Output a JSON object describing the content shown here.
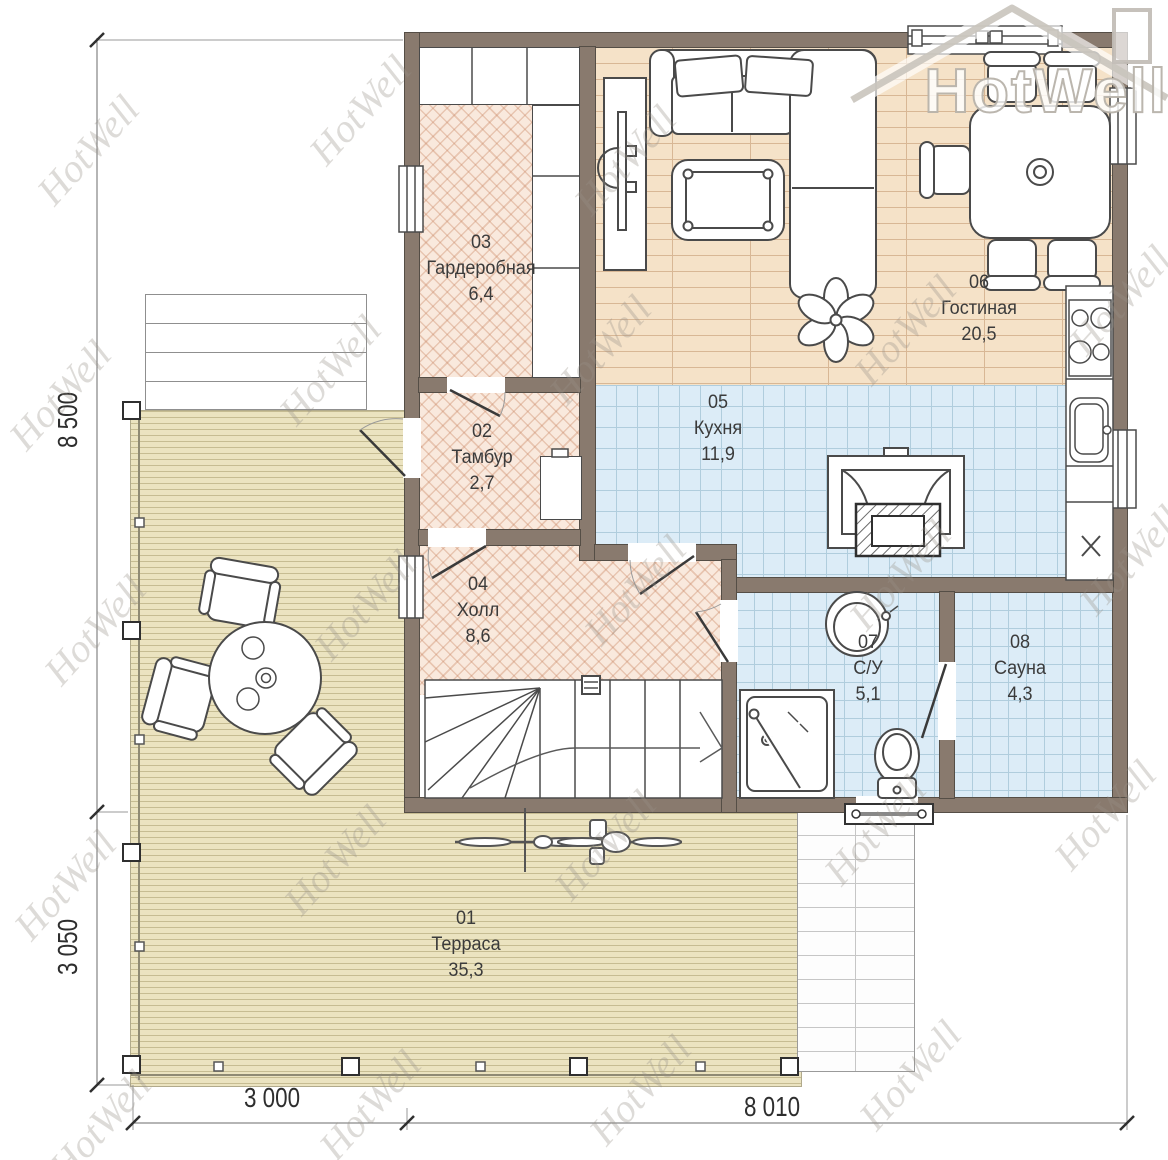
{
  "logo": {
    "brand": "HotWell"
  },
  "watermark": {
    "text": "HotWell"
  },
  "rooms": [
    {
      "number": "01",
      "name": "Терраса",
      "area": "35,3"
    },
    {
      "number": "02",
      "name": "Тамбур",
      "area": "2,7"
    },
    {
      "number": "03",
      "name": "Гардеробная",
      "area": "6,4"
    },
    {
      "number": "04",
      "name": "Холл",
      "area": "8,6"
    },
    {
      "number": "05",
      "name": "Кухня",
      "area": "11,9"
    },
    {
      "number": "06",
      "name": "Гостиная",
      "area": "20,5"
    },
    {
      "number": "07",
      "name": "С/У",
      "area": "5,1"
    },
    {
      "number": "08",
      "name": "Сауна",
      "area": "4,3"
    }
  ],
  "dimensions": {
    "left_top": "8 500",
    "left_bottom": "3 050",
    "bottom_left": "3 000",
    "bottom_right": "8 010"
  },
  "colors": {
    "wall": "#897a6e",
    "herringbone_floor": "#f9e9dd",
    "tile_floor": "#dcecf7",
    "wood_floor": "#f5e2c8",
    "deck_floor": "#ebe3c0"
  }
}
